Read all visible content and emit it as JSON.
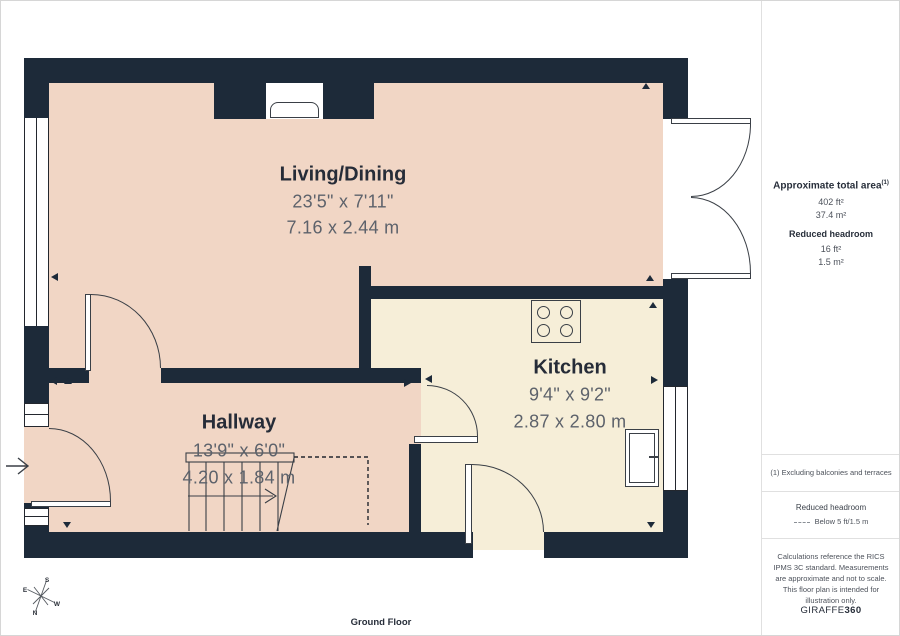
{
  "plan": {
    "floor_label": "Ground Floor",
    "rooms": {
      "living": {
        "name": "Living/Dining",
        "imperial": "23'5\" x 7'11\"",
        "metric": "7.16 x 2.44 m"
      },
      "kitchen": {
        "name": "Kitchen",
        "imperial": "9'4\" x 9'2\"",
        "metric": "2.87 x 2.80 m"
      },
      "hallway": {
        "name": "Hallway",
        "imperial": "13'9\" x 6'0\"",
        "metric": "4.20 x 1.84 m"
      }
    },
    "compass": {
      "n": "N",
      "s": "S",
      "e": "E",
      "w": "W"
    }
  },
  "sidebar": {
    "total_area": {
      "label": "Approximate total area",
      "sup": "(1)",
      "imperial": "402 ft²",
      "metric": "37.4 m²"
    },
    "reduced_headroom": {
      "label": "Reduced headroom",
      "imperial": "16 ft²",
      "metric": "1.5 m²"
    },
    "footnote": "(1) Excluding balconies and terraces",
    "legend": {
      "title": "Reduced headroom",
      "item": "Below 5 ft/1.5 m"
    },
    "disclaimer": "Calculations reference the RICS IPMS 3C standard. Measurements are approximate and not to scale. This floor plan is intended for illustration only.",
    "brand": {
      "name": "GIRAFFE",
      "suffix": "360"
    }
  },
  "colors": {
    "wall": "#1d2a39",
    "living_hallway_floor": "#f1d6c5",
    "kitchen_floor": "#f6eed8",
    "line": "#3a3f46",
    "dim_text": "#5d626b",
    "label_text": "#262c38"
  }
}
